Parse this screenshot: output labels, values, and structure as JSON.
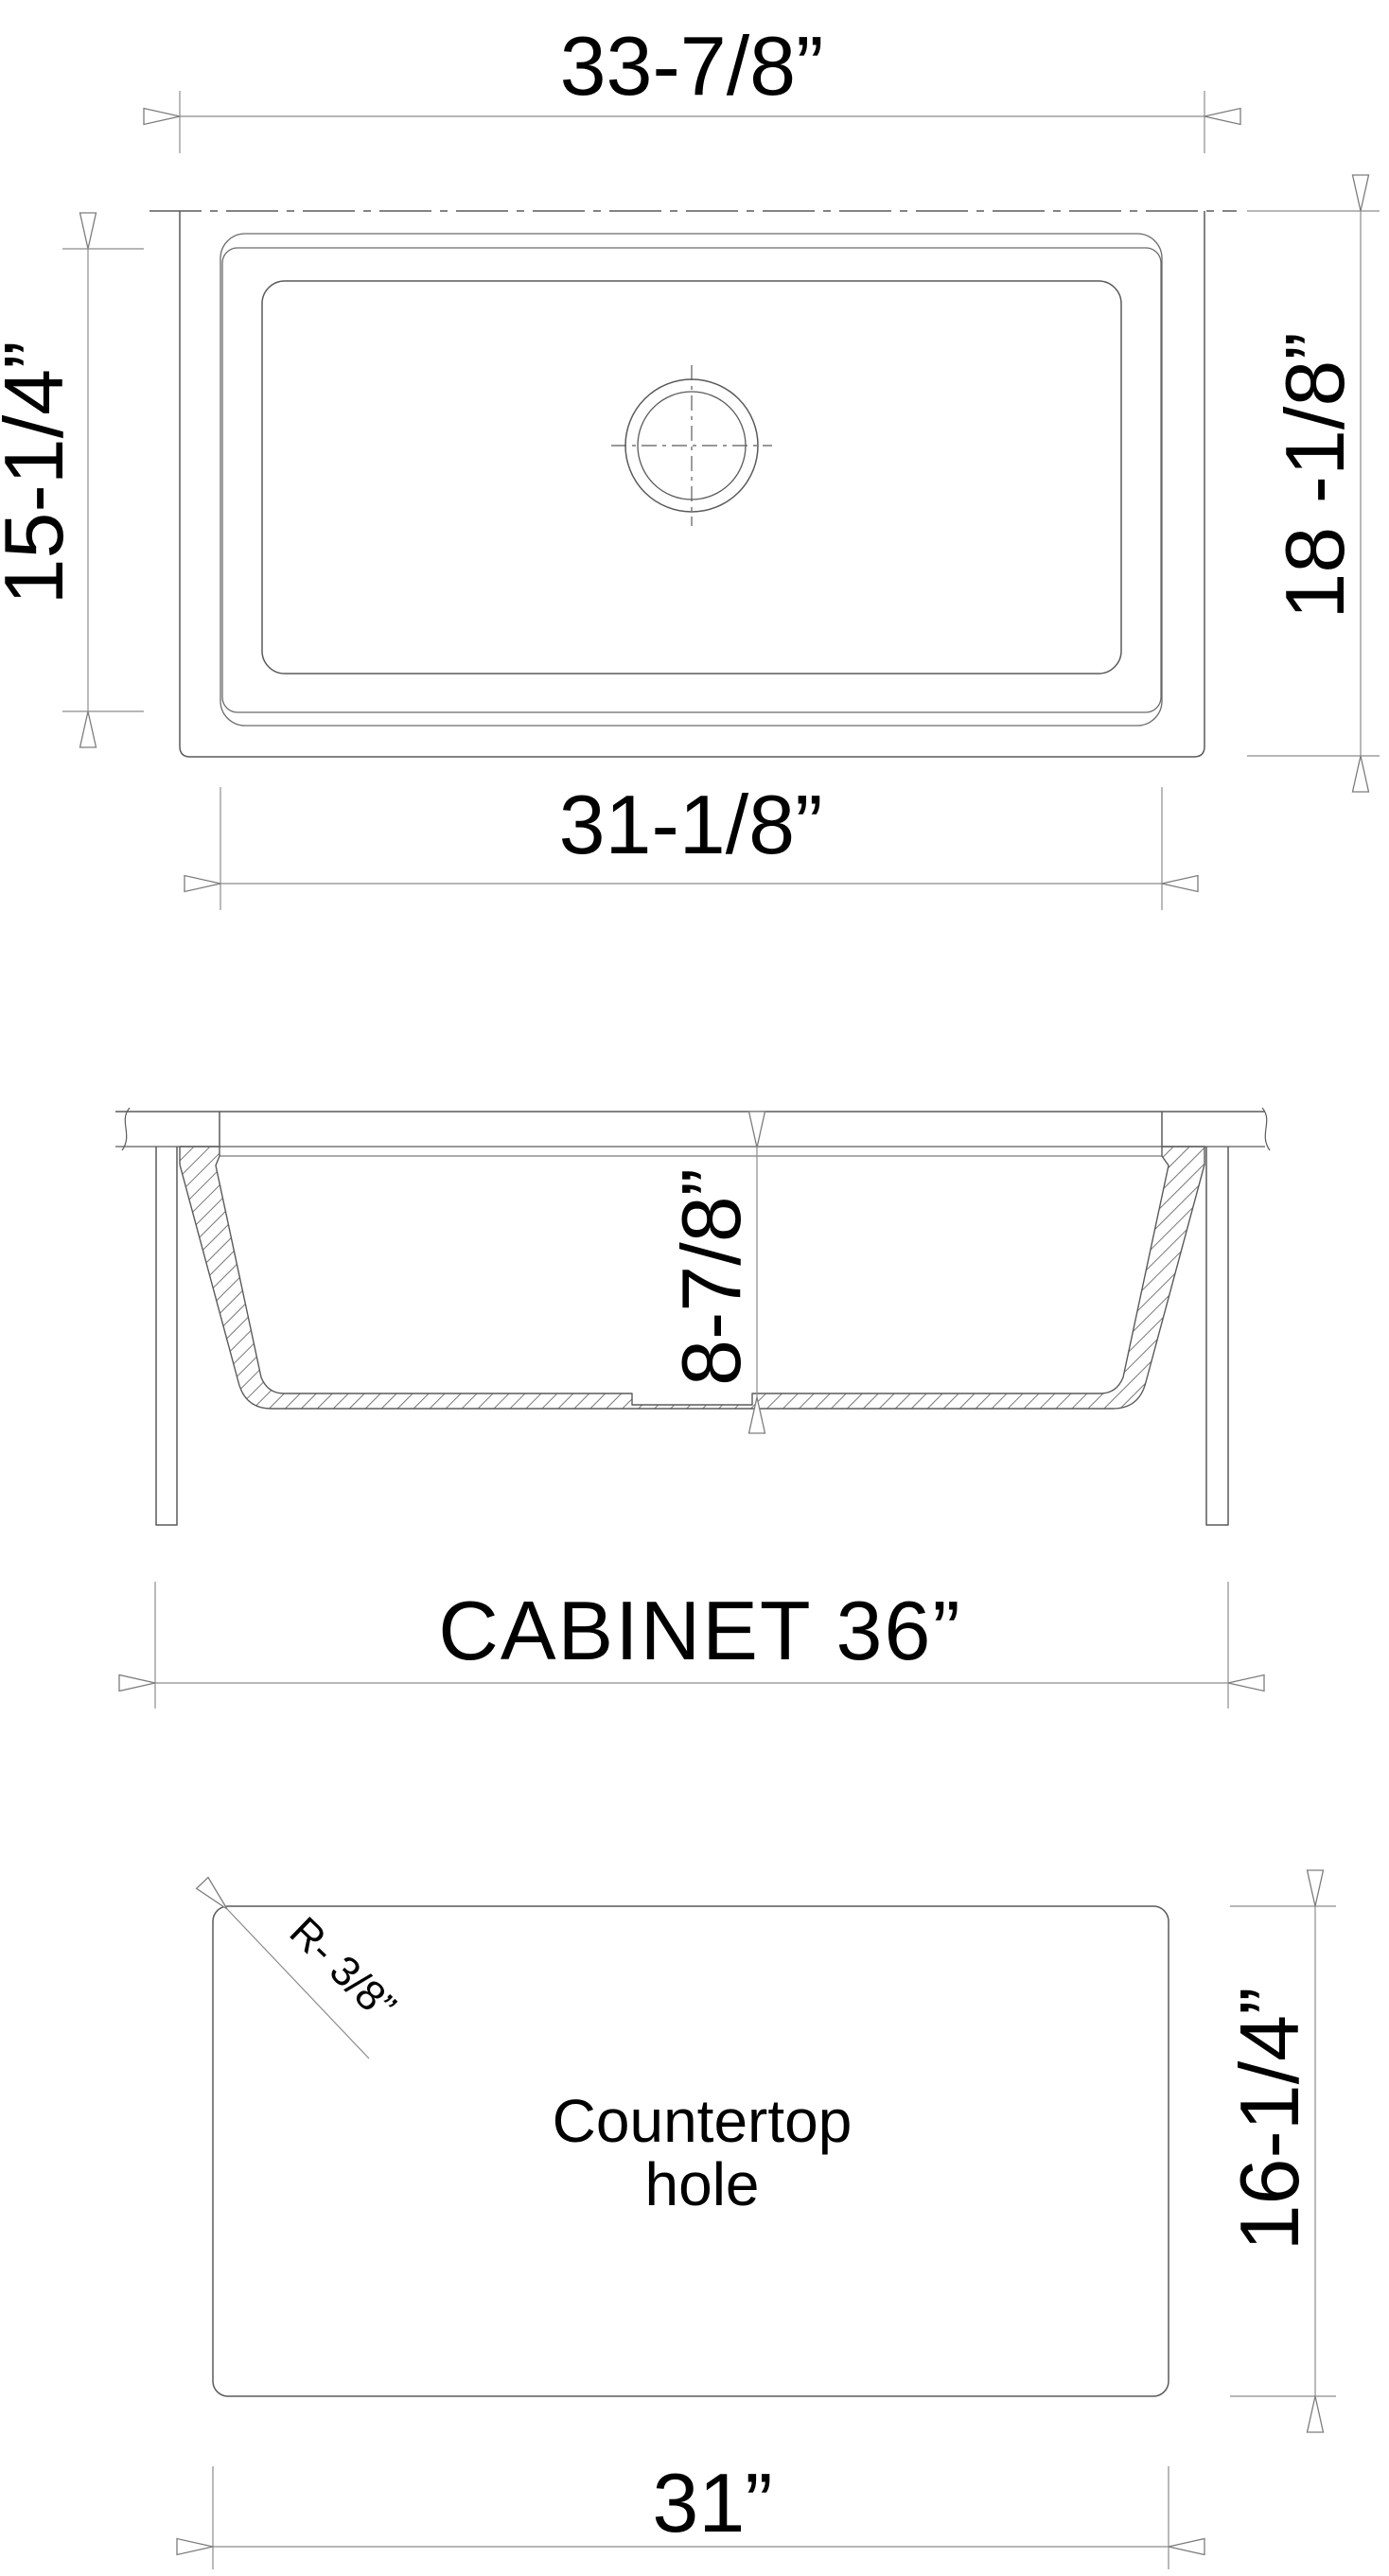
{
  "colors": {
    "object_line": "#5a5a5a",
    "rim_line": "#6a6a6a",
    "dimension_line": "#8c8c8c",
    "text": "#000000",
    "background": "#ffffff"
  },
  "top_view": {
    "overall_width": "33-7/8”",
    "bowl_length": "15-1/4”",
    "overall_depth": "18 -1/8”",
    "bowl_width": "31-1/8”"
  },
  "section_view": {
    "bowl_depth": "8-7/8”",
    "cabinet": "CABINET 36”"
  },
  "countertop_view": {
    "corner_radius": "R- 3/8”",
    "hole_label_line1": "Countertop",
    "hole_label_line2": "hole",
    "cutout_depth": "16-1/4”",
    "cutout_width": "31”"
  }
}
